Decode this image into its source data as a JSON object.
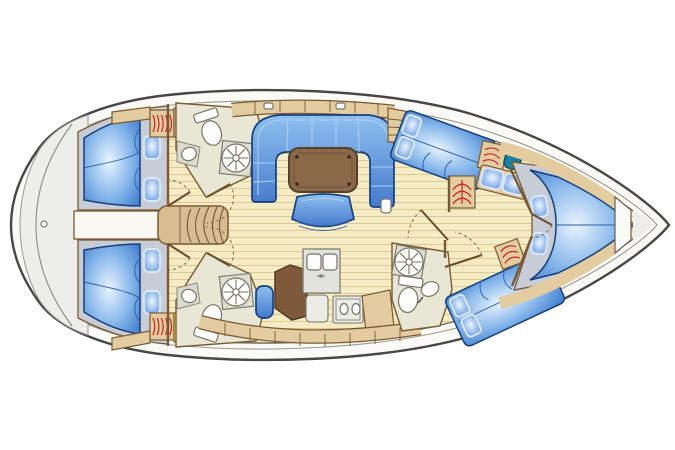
{
  "plan": {
    "type": "sailing-yacht-interior-deck-plan",
    "orientation": {
      "bow": "right",
      "stern": "left"
    },
    "rooms": [
      {
        "id": "aft-cabin-port",
        "name": "Aft double cabin (port)"
      },
      {
        "id": "aft-cabin-starboard",
        "name": "Aft double cabin (starboard)"
      },
      {
        "id": "engine-compartment",
        "name": "Engine compartment"
      },
      {
        "id": "head-aft-port",
        "name": "Head with shower (port)"
      },
      {
        "id": "head-aft-starboard",
        "name": "Head with shower (starboard)"
      },
      {
        "id": "saloon",
        "name": "Saloon with U-settee and table"
      },
      {
        "id": "nav-station",
        "name": "Chart table with seat"
      },
      {
        "id": "galley",
        "name": "Galley with double sink and stove"
      },
      {
        "id": "cabin-mid-port",
        "name": "Midship double cabin (port)"
      },
      {
        "id": "cabin-mid-starboard",
        "name": "Midship double cabin (starboard)"
      },
      {
        "id": "head-mid",
        "name": "Midship head with shower"
      },
      {
        "id": "forward-cabin",
        "name": "Forward V-berth cabin"
      },
      {
        "id": "anchor-locker",
        "name": "Anchor locker"
      }
    ],
    "icons": [
      {
        "id": "hanging-locker-icon",
        "meaning": "hanging locker (red hanger squiggles)"
      },
      {
        "id": "wet-locker-jacket-icon",
        "meaning": "wet locker with foul weather jacket"
      },
      {
        "id": "lifejacket-locker-icon",
        "meaning": "locker with yellow lifejacket symbol"
      },
      {
        "id": "shower-vent-fan-icon",
        "meaning": "shower compartment fan"
      },
      {
        "id": "vanity-sink-icon",
        "meaning": "teal wash basin"
      },
      {
        "id": "backstay-fitting-icon",
        "meaning": "stern deck fitting"
      }
    ]
  },
  "palette": {
    "hull": "#fbfaf6",
    "outline": "#474747",
    "innerLine": "#9a9a94",
    "trunk": "#6f6a60",
    "floor": "#f5ebc4",
    "plank": "#dfc894",
    "sternDeck": "#ededea",
    "wood": "#e3cda0",
    "woodDark": "#d8bd90",
    "woodBorder": "#7a5a33",
    "table": "#8a6848",
    "tableDark": "#52402a",
    "navTable": "#7e5a3a",
    "blueDark": "#16407c",
    "seam": "#a9d0f2",
    "cabinFloor": "#c8ccd7",
    "headFloor": "#e8e6d4",
    "pan": "#dfddd0",
    "fixture": "#fdfdfb",
    "fixtureBorder": "#77756a",
    "appliance": "#ecece7",
    "red": "#cf2020",
    "yellow": "#f2e93e",
    "green": "#1f6b1f",
    "teal": "#19809e",
    "tealDark": "#0c4a5e",
    "setteeTop": "#8fc0ef",
    "setteeBottom": "#4579cc",
    "mattCenter": "#e8f4ff",
    "mattMid": "#7db0e8",
    "mattOuter": "#2f6cc4",
    "pillowCenter": "#eef6ff",
    "pillowOuter": "#5590dd"
  }
}
